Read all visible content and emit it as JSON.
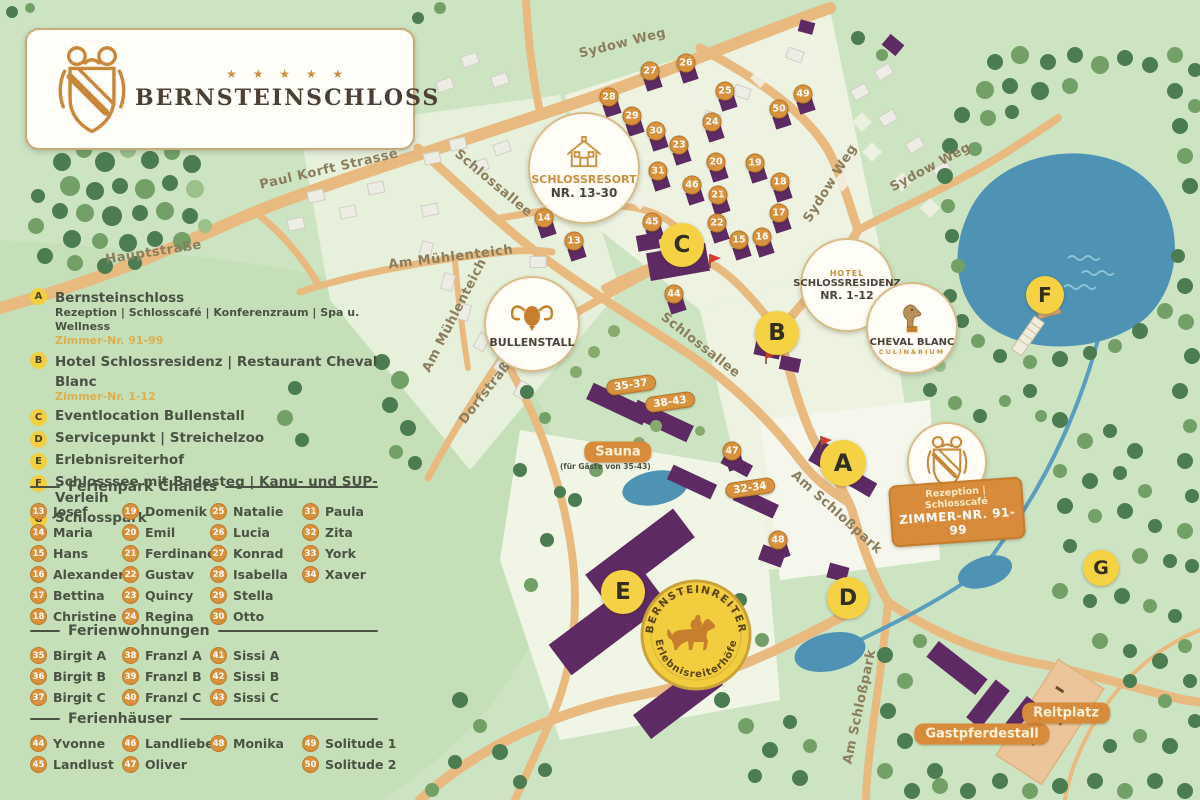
{
  "logo": {
    "stars": "★ ★ ★ ★ ★",
    "title": "BERNSTEINSCHLOSS"
  },
  "legend": {
    "items": [
      {
        "letter": "A",
        "text": "Bernsteinschloss",
        "sub": "Rezeption | Schlosscafé | Konferenzraum | Spa u. Wellness",
        "rooms": "Zimmer-Nr. 91-99"
      },
      {
        "letter": "B",
        "text": "Hotel Schlossresidenz | Restaurant Cheval Blanc",
        "rooms": "Zimmer-Nr. 1-12"
      },
      {
        "letter": "C",
        "text": "Eventlocation Bullenstall"
      },
      {
        "letter": "D",
        "text": "Servicepunkt | Streichelzoo"
      },
      {
        "letter": "E",
        "text": "Erlebnisreiterhof"
      },
      {
        "letter": "F",
        "text": "Schlosssee mit Badesteg | Kanu- und SUP-Verleih"
      },
      {
        "letter": "G",
        "text": "Schlosspark"
      }
    ]
  },
  "sections": {
    "chalets": {
      "title": "Ferienpark Chalets",
      "items": [
        {
          "num": "13",
          "name": "Josef"
        },
        {
          "num": "14",
          "name": "Maria"
        },
        {
          "num": "15",
          "name": "Hans"
        },
        {
          "num": "16",
          "name": "Alexander"
        },
        {
          "num": "17",
          "name": "Bettina"
        },
        {
          "num": "18",
          "name": "Christine"
        },
        {
          "num": "19",
          "name": "Domenik"
        },
        {
          "num": "20",
          "name": "Emil"
        },
        {
          "num": "21",
          "name": "Ferdinand"
        },
        {
          "num": "22",
          "name": "Gustav"
        },
        {
          "num": "23",
          "name": "Quincy"
        },
        {
          "num": "24",
          "name": "Regina"
        },
        {
          "num": "25",
          "name": "Natalie"
        },
        {
          "num": "26",
          "name": "Lucia"
        },
        {
          "num": "27",
          "name": "Konrad"
        },
        {
          "num": "28",
          "name": "Isabella"
        },
        {
          "num": "29",
          "name": "Stella"
        },
        {
          "num": "30",
          "name": "Otto"
        },
        {
          "num": "31",
          "name": "Paula"
        },
        {
          "num": "32",
          "name": "Zita"
        },
        {
          "num": "33",
          "name": "York"
        },
        {
          "num": "34",
          "name": "Xaver"
        }
      ]
    },
    "wohnungen": {
      "title": "Ferienwohnungen",
      "items": [
        {
          "num": "35",
          "name": "Birgit A"
        },
        {
          "num": "36",
          "name": "Birgit B"
        },
        {
          "num": "37",
          "name": "Birgit C"
        },
        {
          "num": "38",
          "name": "Franzl A"
        },
        {
          "num": "39",
          "name": "Franzl B"
        },
        {
          "num": "40",
          "name": "Franzl C"
        },
        {
          "num": "41",
          "name": "Sissi A"
        },
        {
          "num": "42",
          "name": "Sissi B"
        },
        {
          "num": "43",
          "name": "Sissi C"
        }
      ]
    },
    "haeuser": {
      "title": "Ferienhäuser",
      "items": [
        {
          "num": "44",
          "name": "Yvonne"
        },
        {
          "num": "45",
          "name": "Landlust"
        },
        {
          "num": "46",
          "name": "Landliebe"
        },
        {
          "num": "47",
          "name": "Oliver"
        },
        {
          "num": "48",
          "name": "Monika"
        },
        {
          "num": "49",
          "name": "Solitude 1"
        },
        {
          "num": "50",
          "name": "Solitude 2"
        }
      ]
    }
  },
  "map": {
    "streets": [
      {
        "name": "Hauptstraße"
      },
      {
        "name": "Paul Korft Strasse"
      },
      {
        "name": "Schlossallee"
      },
      {
        "name": "Am Mühlenteich"
      },
      {
        "name": "Am Mühlenteich"
      },
      {
        "name": "Dorfstraße"
      },
      {
        "name": "Schlossallee"
      },
      {
        "name": "Sydow Weg"
      },
      {
        "name": "Sydow Weg"
      },
      {
        "name": "Sydow Weg"
      },
      {
        "name": "Am Schloßpark"
      },
      {
        "name": "Am Schloßpark"
      }
    ],
    "badges": {
      "schlossresort": {
        "line1": "SCHLOSSRESORT",
        "line2": "NR. 13-30"
      },
      "bullenstall": {
        "line1": "BULLENSTALL"
      },
      "residenz": {
        "eyebrow": "HOTEL",
        "line1": "SCHLOSSRESIDENZ",
        "line2": "NR. 1-12"
      },
      "cheval": {
        "line1": "CHEVAL BLANC",
        "line2": "CULINARIUM"
      },
      "rezeption": {
        "line1": "Rezeption | Schlosscafé",
        "line2": "ZIMMER-NR. 91-99"
      },
      "bernsteinreiter": {
        "arc_top": "BERNSTEINREITER",
        "arc_bottom": "Erlebnisreiterhöfe"
      }
    },
    "labels": {
      "sauna": "Sauna",
      "sauna_note": "(für Gäste von 35-43)",
      "gastpferdestall": "Gastpferdestall",
      "reitplatz": "Reitplatz"
    },
    "unit_markers": [
      "13",
      "14",
      "15",
      "16",
      "17",
      "18",
      "19",
      "20",
      "21",
      "22",
      "23",
      "24",
      "25",
      "26",
      "27",
      "28",
      "29",
      "30",
      "31",
      "44",
      "45",
      "46",
      "47",
      "48",
      "49",
      "50"
    ],
    "group_markers": [
      "35-37",
      "38-43",
      "32-34"
    ],
    "letter_markers": [
      "A",
      "B",
      "C",
      "D",
      "E",
      "F",
      "G"
    ]
  }
}
